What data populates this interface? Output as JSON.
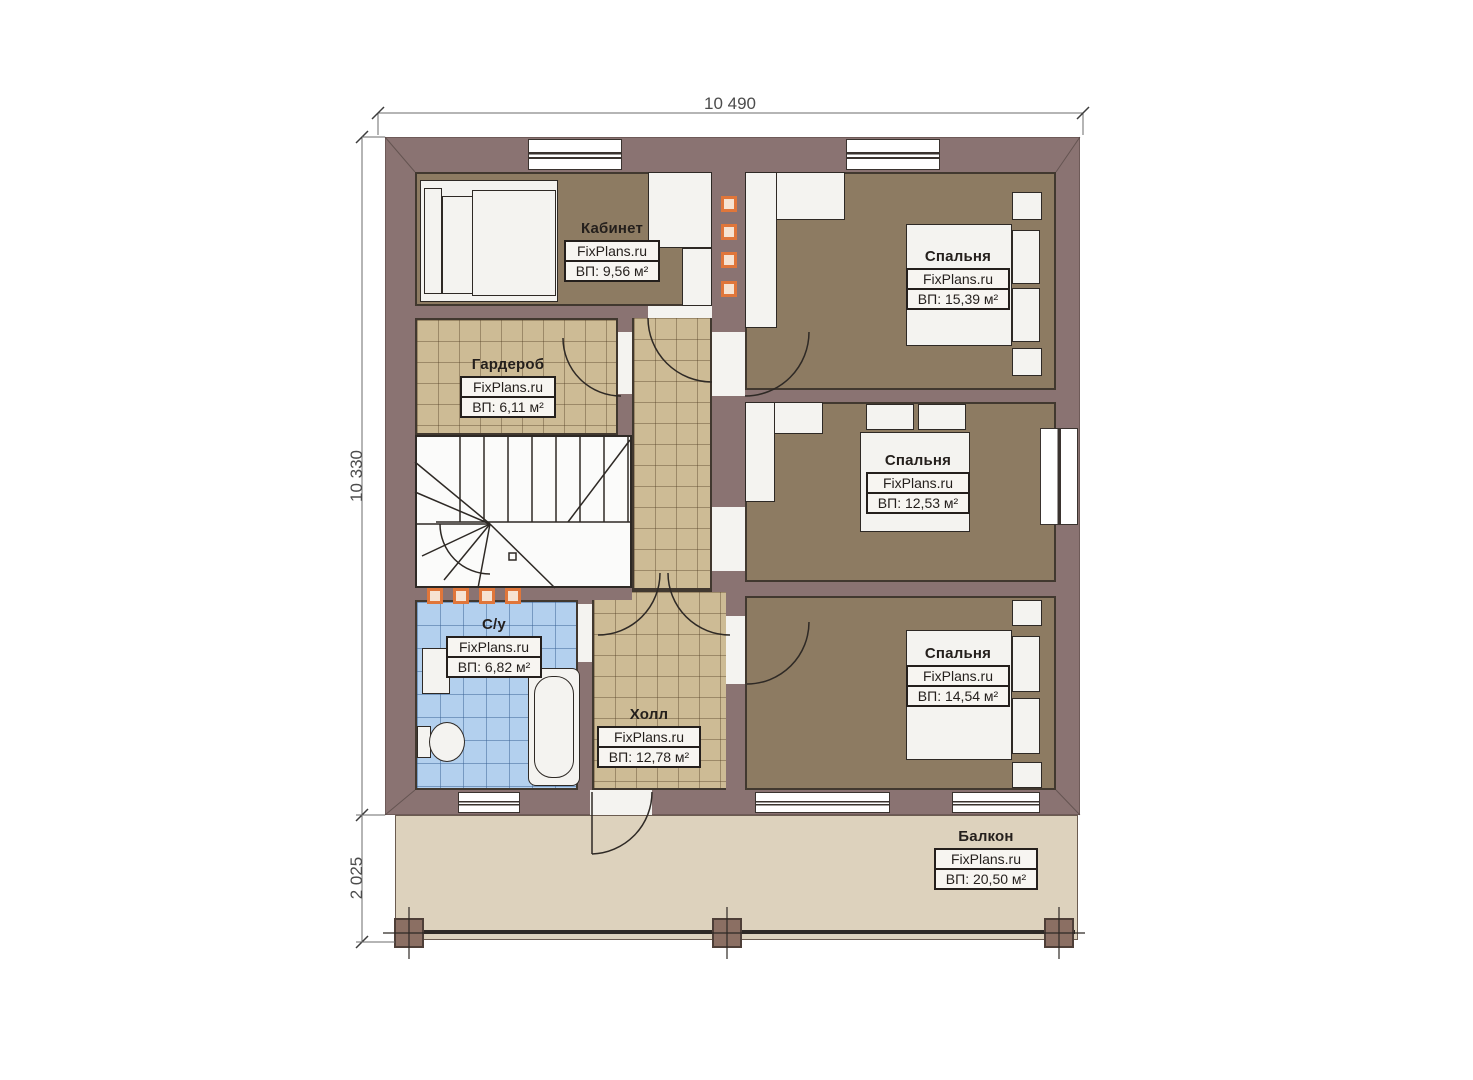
{
  "dims": {
    "top": "10 490",
    "left": "10 330",
    "balcony": "2 025"
  },
  "rooms": {
    "kabinet": {
      "name": "Кабинет",
      "brand": "FixPlans.ru",
      "area": "ВП: 9,56 м²"
    },
    "garderob": {
      "name": "Гардероб",
      "brand": "FixPlans.ru",
      "area": "ВП: 6,11 м²"
    },
    "bedroom_top": {
      "name": "Спальня",
      "brand": "FixPlans.ru",
      "area": "ВП: 15,39 м²"
    },
    "bedroom_mid": {
      "name": "Спальня",
      "brand": "FixPlans.ru",
      "area": "ВП: 12,53 м²"
    },
    "bedroom_bottom": {
      "name": "Спальня",
      "brand": "FixPlans.ru",
      "area": "ВП: 14,54 м²"
    },
    "sanuzel": {
      "name": "С/у",
      "brand": "FixPlans.ru",
      "area": "ВП: 6,82 м²"
    },
    "hall": {
      "name": "Холл",
      "brand": "FixPlans.ru",
      "area": "ВП: 12,78 м²"
    },
    "balcony": {
      "name": "Балкон",
      "brand": "FixPlans.ru",
      "area": "ВП: 20,50 м²"
    }
  },
  "colors": {
    "wall": "#8a7372",
    "floor_room": "#8d7b62",
    "floor_tile": "#cdbb95",
    "floor_bath": "#b3d0ee",
    "floor_balcony": "#ddd2bd",
    "accent_vent": "#e0763a",
    "line": "#2e2925"
  }
}
